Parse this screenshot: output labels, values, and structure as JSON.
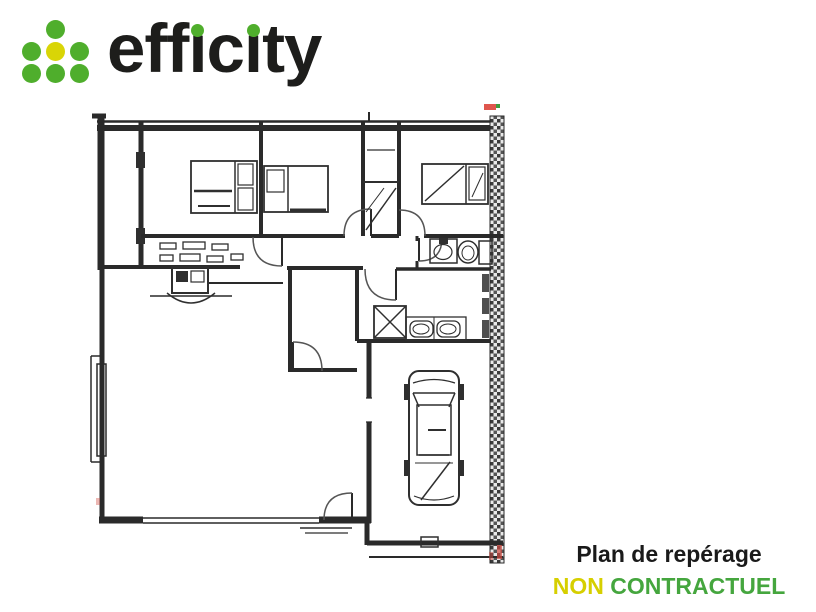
{
  "logo": {
    "brand": "efficity",
    "word_eff": "eff",
    "dotless_i": "ı",
    "word_c": "c",
    "word_ty": "ty"
  },
  "caption": {
    "title": "Plan de repérage",
    "badge_word1": "NON",
    "badge_word2": "CONTRACTUEL"
  },
  "colors": {
    "logo_green": "#4fae2c",
    "logo_yellow": "#d9d506",
    "logo_text": "#1d1d1b",
    "caption_title": "#1a1a1a",
    "caption_non": "#d6cf00",
    "caption_contractuel": "#45a63e",
    "plan_ink": "#2a2a2a",
    "scan_red": "#df564d",
    "background": "#ffffff"
  },
  "floor_plan": {
    "kind": "scanned architectural floor plan, no text labels",
    "depicted_elements": [
      "exterior walls",
      "hatched right wall",
      "three bedrooms with beds",
      "wardrobe column",
      "dressing storage strip",
      "corridor",
      "bathroom with washbasin and toilet",
      "utility room with washing machine and double basin",
      "stove with hearth arc",
      "central storage room",
      "living room",
      "garage with car seen from above",
      "garage door",
      "door swing arcs",
      "window openings",
      "red scan marks"
    ]
  }
}
